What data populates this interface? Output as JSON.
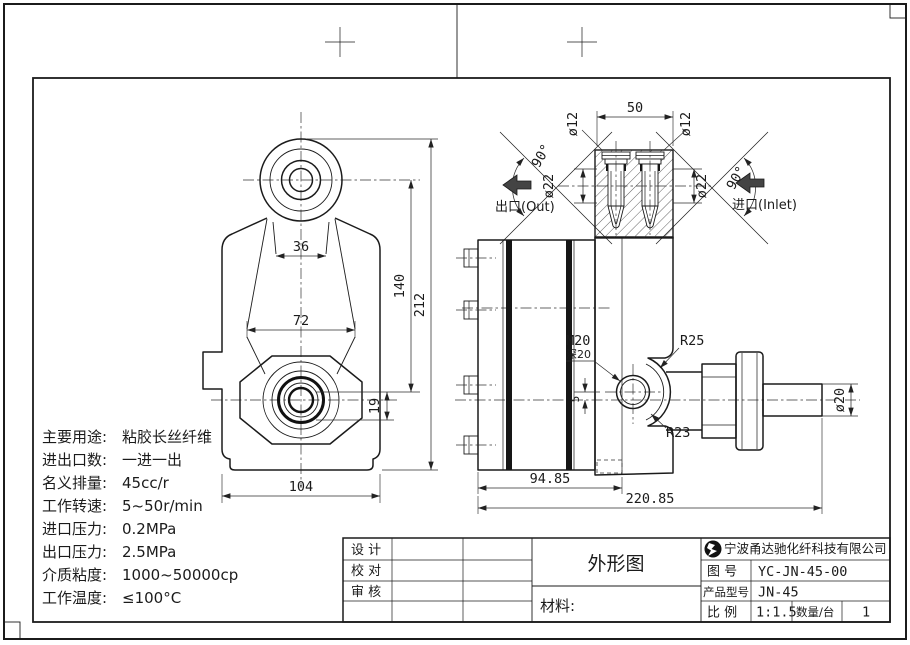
{
  "sheet": {
    "views": {
      "front": {
        "dims": {
          "fork_width": "36",
          "body_width": "72",
          "base_width": "104",
          "center_height": "140",
          "total_height": "212",
          "offset": "19"
        }
      },
      "side": {
        "dims": {
          "body_length": "94.85",
          "total_length": "220.85",
          "shaft_dia": "ø20",
          "port_offset": "5"
        },
        "labels": {
          "thread": "M20",
          "thread_depth": "深20",
          "radius_outer": "R25",
          "radius_inner": "R23"
        }
      },
      "section": {
        "dims": {
          "port_spacing": "50",
          "cartridge_dia": "ø12",
          "port_dia": "ø22",
          "cone_angle": "90°"
        },
        "outlet": "出口(Out)",
        "inlet": "进口(Inlet)"
      }
    },
    "specs": {
      "lines": [
        {
          "label": "主要用途:",
          "value": "粘胶长丝纤维"
        },
        {
          "label": "进出口数:",
          "value": "一进一出"
        },
        {
          "label": "名义排量:",
          "value": "45cc/r"
        },
        {
          "label": "工作转速:",
          "value": "5~50r/min"
        },
        {
          "label": "进口压力:",
          "value": "0.2MPa"
        },
        {
          "label": "出口压力:",
          "value": "2.5MPa"
        },
        {
          "label": "介质粘度:",
          "value": "1000~50000cp"
        },
        {
          "label": "工作温度:",
          "value": "≤100°C"
        }
      ]
    },
    "title_block": {
      "design_label": "设  计",
      "check_label": "校  对",
      "review_label": "审  核",
      "drawing_title": "外形图",
      "material_label": "材料:",
      "company": "宁波甬达驰化纤科技有限公司",
      "drawing_no_label": "图  号",
      "drawing_no": "YC-JN-45-00",
      "model_label": "产品型号",
      "model": "JN-45",
      "scale_label": "比  例",
      "scale": "1:1.5",
      "qty_label": "数量/台",
      "qty": "1"
    }
  }
}
